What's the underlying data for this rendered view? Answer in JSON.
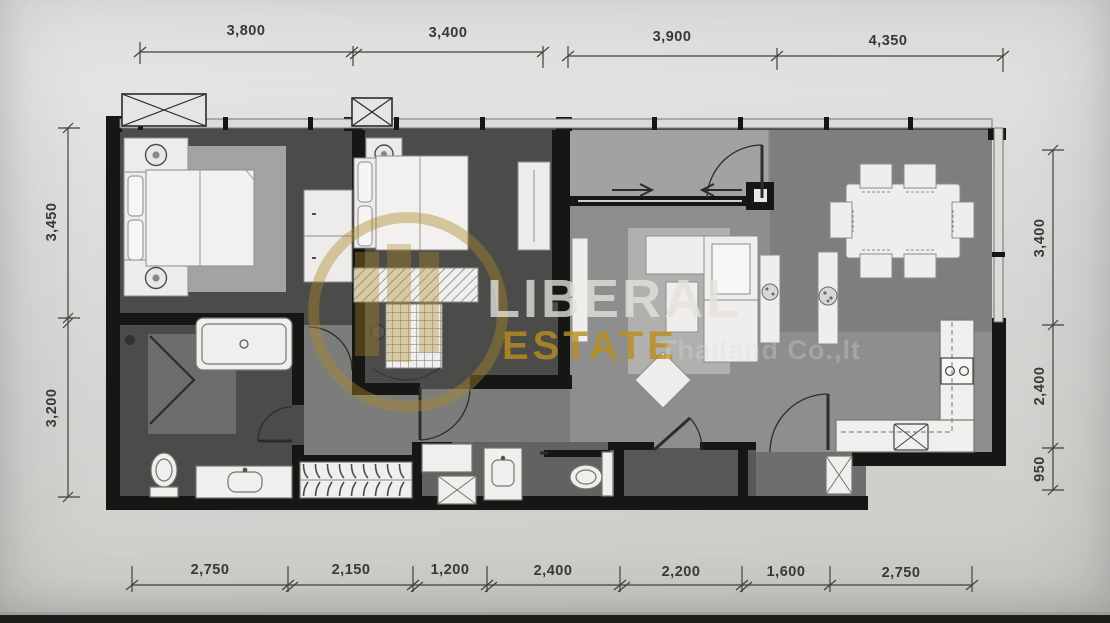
{
  "watermark": {
    "brand_top": "LIBERAL",
    "brand_bottom": "ESTATE",
    "brand_suffix": "Thailand Co.,lt",
    "gold_color": "#ae8826"
  },
  "dimensions": {
    "top": [
      "3,800",
      "3,400",
      "3,900",
      "4,350"
    ],
    "left": [
      "3,450",
      "3,200"
    ],
    "right": [
      "3,400",
      "2,400",
      "950"
    ],
    "bottom": [
      "2,750",
      "2,150",
      "1,200",
      "2,400",
      "2,200",
      "1,600",
      "2,750"
    ]
  },
  "plan": {
    "type": "2-bedroom unit floor plan",
    "fixtures": [
      "double-bed",
      "nightstand-lamp",
      "wardrobe",
      "bathtub",
      "folding-shower-screen",
      "toilet",
      "vanity-sink",
      "hanger-rail",
      "washing-machine",
      "sliding-door",
      "entrance-door",
      "dining-table",
      "dining-chair",
      "sofa",
      "coffee-table",
      "diamond-ottoman",
      "side-table-plant",
      "tv-console",
      "kitchen-counter",
      "stove",
      "kitchen-sink",
      "refrigerator",
      "air-conditioner-unit"
    ],
    "wall_color": "#161614",
    "bedroom_floor_color": "#4b4b49",
    "living_floor_color": "#8e8e8c"
  }
}
